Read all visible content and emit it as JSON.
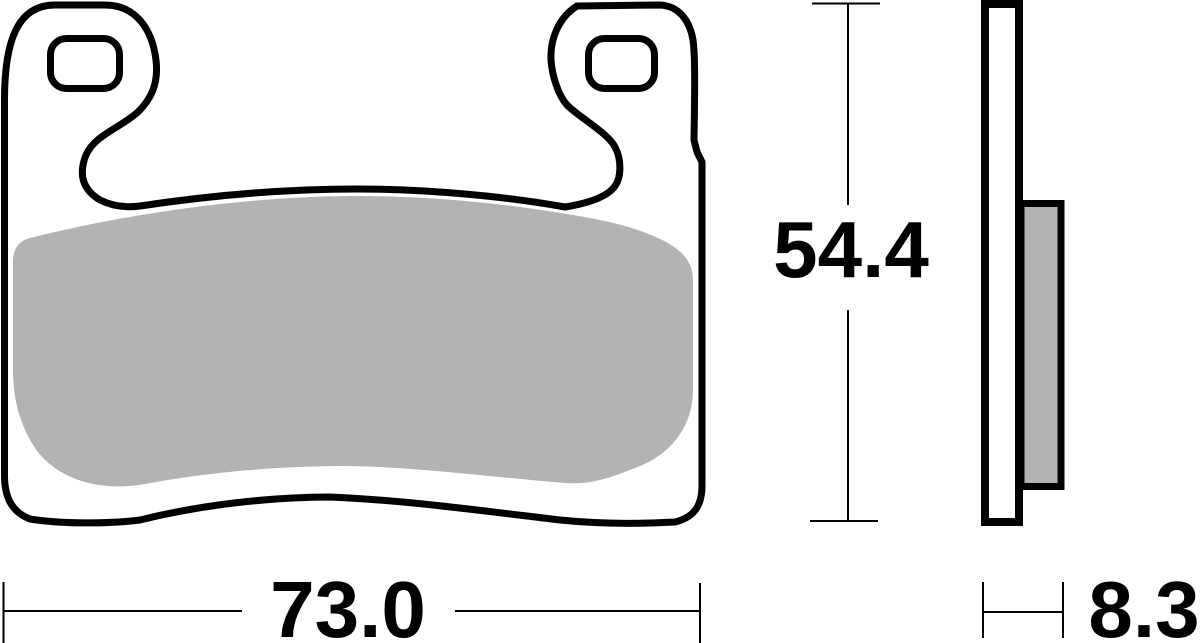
{
  "dimensions": {
    "width_mm": {
      "label": "73.0",
      "value": 73.0
    },
    "height_mm": {
      "label": "54.4",
      "value": 54.4
    },
    "thickness_mm": {
      "label": "8.3",
      "value": 8.3
    }
  },
  "colors": {
    "line": "#000000",
    "friction_material": "#b3b3b3",
    "background": "#ffffff"
  }
}
